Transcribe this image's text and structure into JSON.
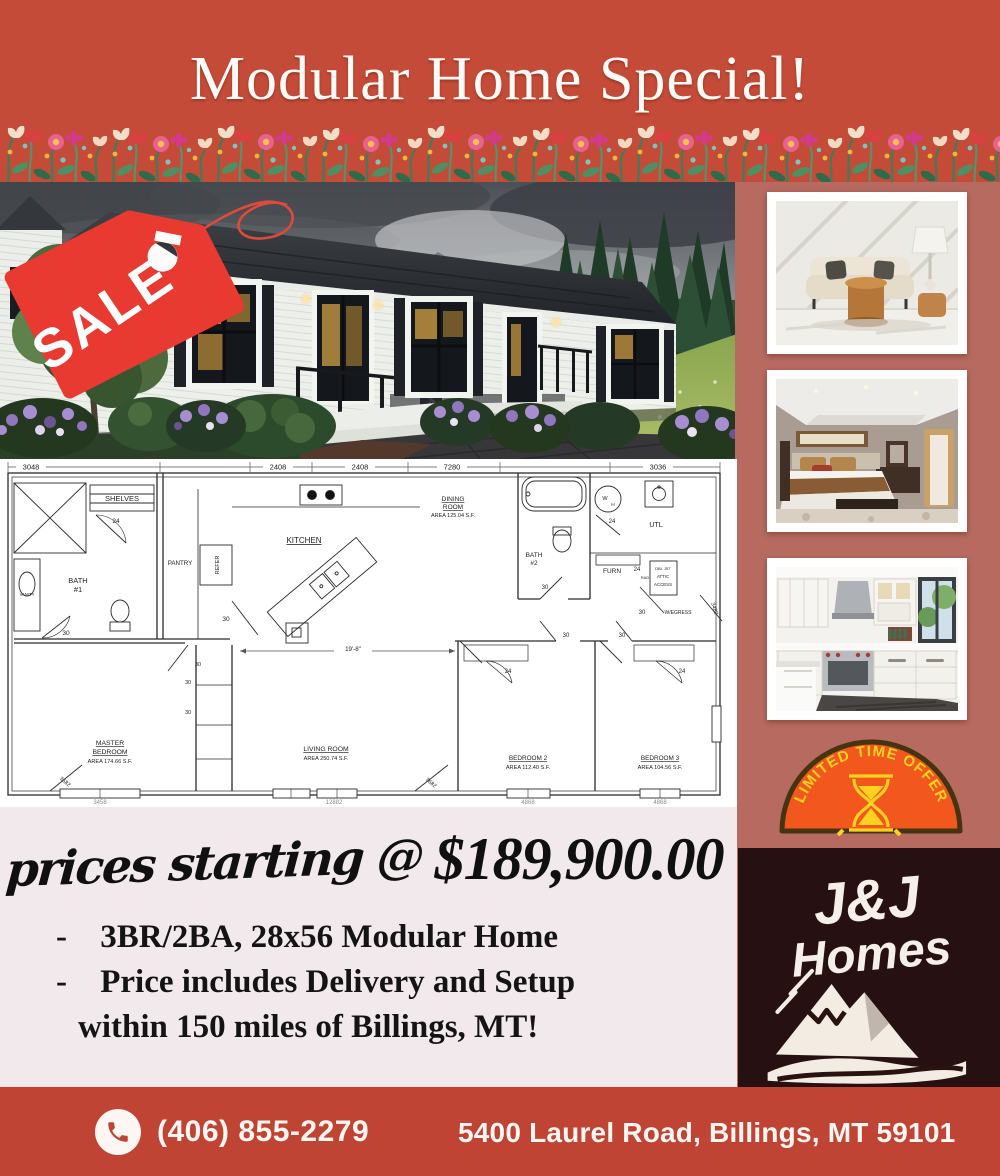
{
  "flyer": {
    "title": "Modular Home Special!",
    "sale_tag": "SALE",
    "badge_text": "LIMITED TIME OFFER",
    "logo_line1": "J&J",
    "logo_line2": "Homes",
    "price_script": "prices starting @",
    "price_amount": "$189,900.00",
    "bullet_dash": "-",
    "bullet1": "3BR/2BA, 28x56 Modular Home",
    "bullet2_line1": "Price includes Delivery and Setup",
    "bullet2_line2": "within 150 miles of Billings, MT!",
    "phone": "(406) 855-2279",
    "address": "5400 Laurel Road, Billings, MT 59101",
    "colors": {
      "header_red": "#c34b37",
      "footer_red": "#c04433",
      "sidebar_salmon": "#b66a60",
      "panel_pink": "#f2e9ed",
      "logo_dark": "#271011",
      "tag_red": "#e83a30",
      "badge_orange": "#f2571d",
      "badge_yellow": "#ffd21f"
    }
  },
  "floor_plan": {
    "s24": "24",
    "s30": "30",
    "dims_top": [
      "3048",
      "2408",
      "2408",
      "7280",
      "3036"
    ],
    "dims_bottom": [
      "3458",
      "12882",
      "4868",
      "4868"
    ],
    "living_dim": "19'-8\"",
    "door_master": "3682",
    "door_living": "3682",
    "door_util": "3482",
    "labels": {
      "shelves": "SHELVES",
      "bath1_l1": "BATH",
      "bath1_l2": "#1",
      "vanity": "VANITY",
      "pantry": "PANTRY",
      "refer": "REFER",
      "kitchen": "KITCHEN",
      "dining_l1": "DINING",
      "dining_l2": "ROOM",
      "dining_area": "AREA 125.04 S.F.",
      "bath2_l1": "BATH",
      "bath2_l2": "#2",
      "wh_l1": "W",
      "wh_l2": "H",
      "utl": "UTL",
      "furn": "FURN",
      "rad": "RAD",
      "attic_l0": "DBL JST",
      "attic_l1": "ATTIC",
      "attic_l2": "ACCESS",
      "egress": "W/EGRESS",
      "master_l1": "MASTER",
      "master_l2": "BEDROOM",
      "master_area": "AREA 174.66 S.F.",
      "living_l1": "LIVING ROOM",
      "living_area": "AREA 250.74 S.F.",
      "bed2_l1": "BEDROOM 2",
      "bed2_area": "AREA 112.40 S.F.",
      "bed3_l1": "BEDROOM 3",
      "bed3_area": "AREA 104.56 S.F."
    }
  },
  "photos": {
    "main": "modular-home-exterior",
    "p1": "living-room-interior",
    "p2": "bedroom-interior",
    "p3": "kitchen-interior"
  }
}
